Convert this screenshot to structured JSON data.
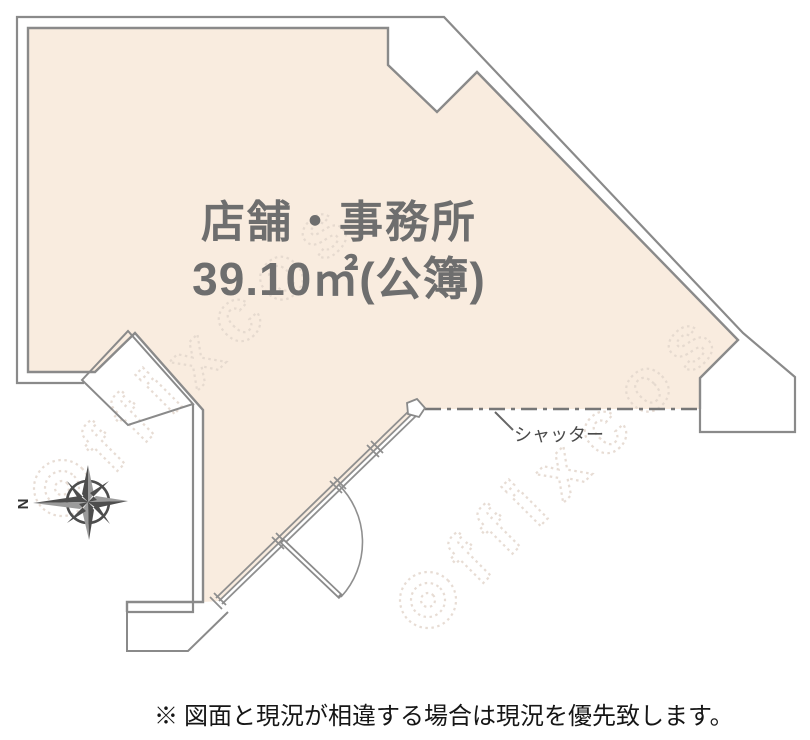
{
  "plan": {
    "room": {
      "name": "店舗・事務所",
      "area": "39.10㎡(公簿)"
    },
    "shutter_label": "シャッター",
    "compass": {
      "north_label": "N"
    },
    "watermark_text": "ffixcos",
    "disclaimer": "※ 図面と現況が相違する場合は現況を優先致します。",
    "colors": {
      "room_fill": "#f9ecdf",
      "wall_stroke": "#8a8a8a",
      "label_gray": "#6e6e6e",
      "shutter_line": "#777777",
      "compass_dark": "#4d4d4d",
      "compass_light": "#9b9b9b",
      "watermark": "#e3d7cd",
      "disclaimer_text": "#161616"
    }
  }
}
